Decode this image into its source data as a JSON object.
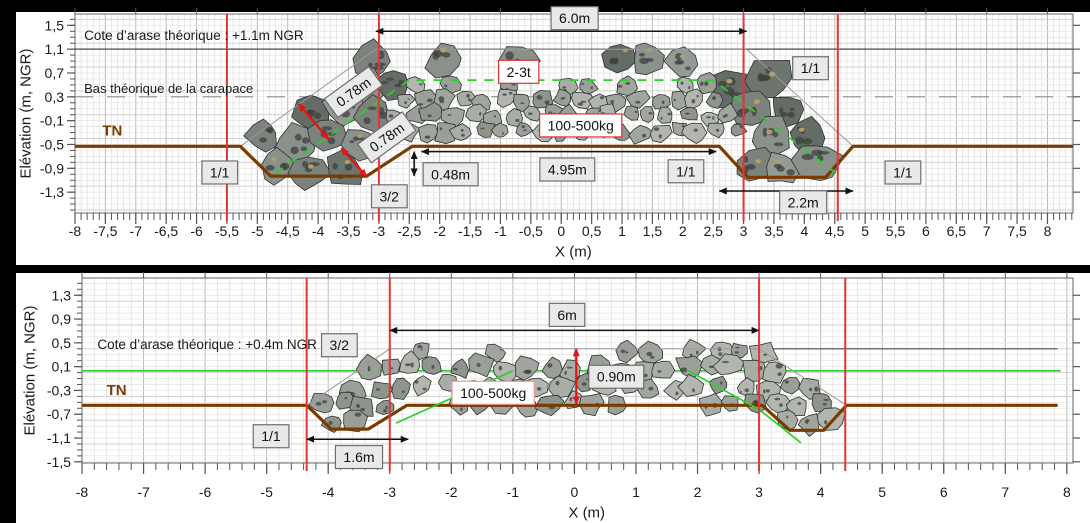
{
  "colors": {
    "background": "#ffffff",
    "bar_black": "#000000",
    "grid_minor": "#dedede",
    "grid_major": "#b9b9b9",
    "grid_hminor": "#e3e3e3",
    "grid_hmajor": "#cdcdcd",
    "frame": "#7f7f7f",
    "tick": "#555555",
    "text": "#1a1a1a",
    "red_line": "#e43434",
    "tn_brown": "#7a3b00",
    "outline_gray": "#9a9a9a",
    "green": "#2bd12b",
    "arase": "#4a4a4a",
    "carapace_dash": "#8c8c8c",
    "arrow_black": "#111111",
    "arrow_red": "#e81212",
    "box_fill": "#e9e9e9",
    "box_border": "#6e6e6e",
    "redbox_border": "#e03030",
    "pinkbox_border": "#f29a9a",
    "rock_stroke": "#2f332f",
    "rock_big": [
      "#6e746e",
      "#7c827c",
      "#8a908a",
      "#656b65",
      "#949a94"
    ],
    "rock_small": [
      "#9aa098",
      "#a8ada6",
      "#b2b6ae",
      "#8f958d",
      "#a0a59d"
    ],
    "speckle": "#3c413c",
    "tan": "#b9a06c"
  },
  "layout": {
    "width": 1090,
    "height": 523,
    "black_bars": [
      {
        "x": 0,
        "y": 0,
        "w": 1090,
        "h": 12
      },
      {
        "x": 0,
        "y": 265,
        "w": 1090,
        "h": 8
      },
      {
        "x": 0,
        "y": 0,
        "w": 16,
        "h": 523
      }
    ]
  },
  "chart_data": {
    "type": "cross-section",
    "charts": [
      {
        "id": "top",
        "plot": {
          "left": 75,
          "top": 14,
          "right": 1073,
          "bottom": 213
        },
        "x": {
          "min": -8,
          "max": 8.42,
          "minor": 0.1,
          "grid_major": 0.5,
          "top_step": 1,
          "values": [
            -8,
            -7.5,
            -7,
            -6.5,
            -6,
            -5.5,
            -5,
            -4.5,
            -4,
            -3.5,
            -3,
            -2.5,
            -2,
            -1.5,
            -1,
            -0.5,
            0,
            0.5,
            1,
            1.5,
            2,
            2.5,
            3,
            3.5,
            4,
            4.5,
            5,
            5.5,
            6,
            6.5,
            7,
            7.5,
            8
          ],
          "labels": [
            "-8",
            "-7,5",
            "-7",
            "-6,5",
            "-6",
            "-5,5",
            "-5",
            "-4,5",
            "-4",
            "-3,5",
            "-3",
            "-2,5",
            "-2",
            "-1,5",
            "-1",
            "-0,5",
            "0",
            "0,5",
            "1",
            "1,5",
            "2",
            "2,5",
            "3",
            "3,5",
            "4",
            "4,5",
            "5",
            "5,5",
            "6",
            "6,5",
            "7",
            "7,5",
            "8"
          ],
          "title": "X (m)",
          "label_dy": 18,
          "title_dy": 39,
          "title_x": 0.2
        },
        "y": {
          "min": -1.65,
          "max": 1.69,
          "minor": 0.1,
          "grid_major": 0.4,
          "values": [
            1.5,
            1.1,
            0.7,
            0.3,
            -0.1,
            -0.5,
            -0.9,
            -1.3
          ],
          "labels": [
            "1,5",
            "1,1",
            "0,7",
            "0,3",
            "-0,1",
            "-0,5",
            "-0,9",
            "-1,3"
          ],
          "title": "Elévation (m, NGR)",
          "title_x": 26
        },
        "hlines": [
          {
            "y": 1.1,
            "x1": -8,
            "x2": 8.42,
            "color": "arase",
            "w": 1.2
          },
          {
            "y": 0.3,
            "x1": -8,
            "x2": 8.42,
            "color": "carapace_dash",
            "w": 1.2,
            "dash": "18 14"
          }
        ],
        "tn_line": [
          [
            -8,
            -0.53
          ],
          [
            -5.28,
            -0.53
          ],
          [
            -4.78,
            -1.03
          ],
          [
            -3.2,
            -1.03
          ],
          [
            -2.45,
            -0.53
          ],
          [
            2.6,
            -0.53
          ],
          [
            3.07,
            -1.05
          ],
          [
            4.35,
            -1.05
          ],
          [
            4.8,
            -0.53
          ],
          [
            8.42,
            -0.53
          ]
        ],
        "outline": [
          [
            -5.28,
            -0.53
          ],
          [
            -3.05,
            1.1
          ],
          [
            3.05,
            1.1
          ],
          [
            4.8,
            -0.53
          ]
        ],
        "green_lines": [
          {
            "pts": [
              [
                -4.7,
                -0.98
              ],
              [
                -2.5,
                0.58
              ],
              [
                2.5,
                0.58
              ],
              [
                4.52,
                -0.98
              ]
            ],
            "dash": "9 8"
          }
        ],
        "red_vlines": [
          -5.5,
          -3,
          3,
          4.55
        ],
        "rock_zones": [
          {
            "poly": [
              [
                -5.25,
                -0.55
              ],
              [
                -3.1,
                0.97
              ],
              [
                3.1,
                0.97
              ],
              [
                4.75,
                -0.55
              ],
              [
                4.32,
                -1.0
              ],
              [
                3.1,
                -1.0
              ],
              [
                2.65,
                -0.56
              ],
              [
                -2.5,
                -0.56
              ],
              [
                -3.25,
                -1.0
              ],
              [
                -4.75,
                -1.0
              ]
            ],
            "exclude": [
              [
                -3.15,
                -0.5
              ],
              [
                -2.55,
                0.6
              ],
              [
                2.55,
                0.6
              ],
              [
                3.15,
                -0.5
              ]
            ],
            "spacing": 0.56,
            "rmin": 0.26,
            "rmax": 0.38,
            "style": "big",
            "seed": 11
          },
          {
            "poly": [
              [
                -3.05,
                -0.52
              ],
              [
                -2.5,
                0.52
              ],
              [
                2.5,
                0.52
              ],
              [
                3.05,
                -0.52
              ]
            ],
            "spacing": 0.32,
            "rmin": 0.13,
            "rmax": 0.19,
            "style": "small",
            "seed": 5
          }
        ],
        "arrows": [
          {
            "x1": -3.05,
            "y1": 1.4,
            "x2": 3.05,
            "y2": 1.4,
            "kind": "black"
          },
          {
            "x1": -2.3,
            "y1": -0.62,
            "x2": 2.55,
            "y2": -0.62,
            "kind": "black"
          },
          {
            "x1": -2.42,
            "y1": -0.62,
            "x2": -2.42,
            "y2": -1.03,
            "kind": "black"
          },
          {
            "x1": 2.6,
            "y1": -1.28,
            "x2": 4.8,
            "y2": -1.28,
            "kind": "black"
          },
          {
            "x1": -4.32,
            "y1": 0.18,
            "x2": -3.82,
            "y2": -0.42,
            "kind": "red"
          },
          {
            "x1": -3.62,
            "y1": -0.56,
            "x2": -3.2,
            "y2": -1.04,
            "kind": "red"
          }
        ],
        "texts": [
          {
            "t": "Cote d’arase théorique : +1.1m NGR",
            "x": -7.85,
            "y": 1.33,
            "size": 13.5
          },
          {
            "t": "Bas théorique de la carapace",
            "x": -7.85,
            "y": 0.44,
            "size": 13
          },
          {
            "t": "TN",
            "x": -7.55,
            "y": -0.27,
            "size": 15,
            "bold": true,
            "brown": true
          }
        ],
        "boxes": [
          {
            "t": "1/1",
            "x": -5.62,
            "y": -0.97,
            "style": "gray"
          },
          {
            "t": "0.78m",
            "x": -3.42,
            "y": 0.38,
            "style": "gray",
            "rot": -36
          },
          {
            "t": "0.78m",
            "x": -2.87,
            "y": -0.38,
            "style": "gray",
            "rot": -36
          },
          {
            "t": "3/2",
            "x": -2.83,
            "y": -1.37,
            "style": "gray"
          },
          {
            "t": "0.48m",
            "x": -1.82,
            "y": -1.0,
            "style": "gray"
          },
          {
            "t": "4.95m",
            "x": 0.1,
            "y": -0.92,
            "style": "gray"
          },
          {
            "t": "1/1",
            "x": 2.05,
            "y": -0.95,
            "style": "gray"
          },
          {
            "t": "6.0m",
            "x": 0.22,
            "y": 1.62,
            "style": "gray"
          },
          {
            "t": "1/1",
            "x": 4.1,
            "y": 0.78,
            "style": "gray"
          },
          {
            "t": "2.2m",
            "x": 3.98,
            "y": -1.47,
            "style": "gray"
          },
          {
            "t": "1/1",
            "x": 5.62,
            "y": -0.97,
            "style": "gray"
          },
          {
            "t": "2-3t",
            "x": -0.7,
            "y": 0.72,
            "style": "red"
          },
          {
            "t": "100-500kg",
            "x": 0.32,
            "y": -0.18,
            "style": "red"
          }
        ]
      },
      {
        "id": "bottom",
        "plot": {
          "left": 82,
          "top": 278,
          "right": 1073,
          "bottom": 463
        },
        "x": {
          "min": -8,
          "max": 8.1,
          "minor": 0.2,
          "grid_major": 1,
          "top_step": 1,
          "values": [
            -8,
            -7,
            -6,
            -5,
            -4,
            -3,
            -2,
            -1,
            0,
            1,
            2,
            3,
            4,
            5,
            6,
            7,
            8
          ],
          "labels": [
            "-8",
            "-7",
            "-6",
            "-5",
            "-4",
            "-3",
            "-2",
            "-1",
            "0",
            "1",
            "2",
            "3",
            "4",
            "5",
            "6",
            "7",
            "8"
          ],
          "title": "X (m)",
          "label_dy": 29,
          "title_dy": 50,
          "title_x": 0.2
        },
        "y": {
          "min": -1.52,
          "max": 1.59,
          "minor": 0.1,
          "grid_major": 0.4,
          "values": [
            1.3,
            0.9,
            0.5,
            0.1,
            -0.3,
            -0.7,
            -1.1,
            -1.5
          ],
          "labels": [
            "1,3",
            "0,9",
            "0,5",
            "0,1",
            "-0,3",
            "-0,7",
            "-1,1",
            "-1,5"
          ],
          "title": "Elévation (m, NGR)",
          "title_x": 30
        },
        "hlines": [
          {
            "y": 0.4,
            "x1": 3.1,
            "x2": 7.85,
            "color": "arase",
            "w": 1.2
          },
          {
            "y": 0.03,
            "x1": -8,
            "x2": 7.9,
            "color": "green",
            "w": 1.7
          }
        ],
        "tn_line": [
          [
            -8,
            -0.55
          ],
          [
            -4.35,
            -0.55
          ],
          [
            -3.95,
            -0.95
          ],
          [
            -3.35,
            -0.95
          ],
          [
            -2.72,
            -0.55
          ],
          [
            3.05,
            -0.55
          ],
          [
            3.5,
            -0.97
          ],
          [
            4.05,
            -0.97
          ],
          [
            4.42,
            -0.55
          ],
          [
            7.85,
            -0.55
          ]
        ],
        "outline": [
          [
            -4.35,
            -0.55
          ],
          [
            -3.0,
            0.4
          ],
          [
            3.0,
            0.4
          ],
          [
            4.42,
            -0.55
          ]
        ],
        "green_lines": [
          {
            "pts": [
              [
                -2.9,
                -0.85
              ],
              [
                -1.0,
                0.03
              ]
            ]
          },
          {
            "pts": [
              [
                1.85,
                0.03
              ],
              [
                3.0,
                -0.62
              ],
              [
                3.68,
                -1.18
              ]
            ]
          }
        ],
        "red_vlines": [
          -4.35,
          -3,
          3,
          4.4
        ],
        "rock_zones": [
          {
            "poly": [
              [
                -4.3,
                -0.57
              ],
              [
                -3.0,
                0.38
              ],
              [
                3.0,
                0.38
              ],
              [
                4.38,
                -0.57
              ],
              [
                4.02,
                -0.93
              ],
              [
                3.52,
                -0.93
              ],
              [
                3.02,
                -0.57
              ],
              [
                -2.72,
                -0.57
              ],
              [
                -3.37,
                -0.93
              ],
              [
                -3.93,
                -0.93
              ]
            ],
            "spacing": 0.37,
            "rmin": 0.15,
            "rmax": 0.22,
            "style": "small",
            "seed": 23
          }
        ],
        "arrows": [
          {
            "x1": -3.0,
            "y1": 0.71,
            "x2": 3.0,
            "y2": 0.71,
            "kind": "black"
          },
          {
            "x1": -4.35,
            "y1": -1.12,
            "x2": -2.7,
            "y2": -1.12,
            "kind": "black"
          },
          {
            "x1": 0.03,
            "y1": 0.4,
            "x2": 0.03,
            "y2": -0.53,
            "kind": "red"
          }
        ],
        "texts": [
          {
            "t": "Cote d’arase théorique : +0.4m NGR",
            "x": -7.75,
            "y": 0.47,
            "size": 13.5
          },
          {
            "t": "TN",
            "x": -7.6,
            "y": -0.3,
            "size": 15,
            "bold": true,
            "brown": true
          }
        ],
        "boxes": [
          {
            "t": "3/2",
            "x": -3.82,
            "y": 0.46,
            "style": "gray"
          },
          {
            "t": "1/1",
            "x": -4.93,
            "y": -1.07,
            "style": "gray"
          },
          {
            "t": "1.6m",
            "x": -3.5,
            "y": -1.42,
            "style": "gray"
          },
          {
            "t": "6m",
            "x": -0.12,
            "y": 0.97,
            "style": "gray"
          },
          {
            "t": "0.90m",
            "x": 0.68,
            "y": -0.07,
            "style": "gray"
          },
          {
            "t": "100-500kg",
            "x": -1.32,
            "y": -0.34,
            "style": "pink"
          }
        ]
      }
    ]
  }
}
